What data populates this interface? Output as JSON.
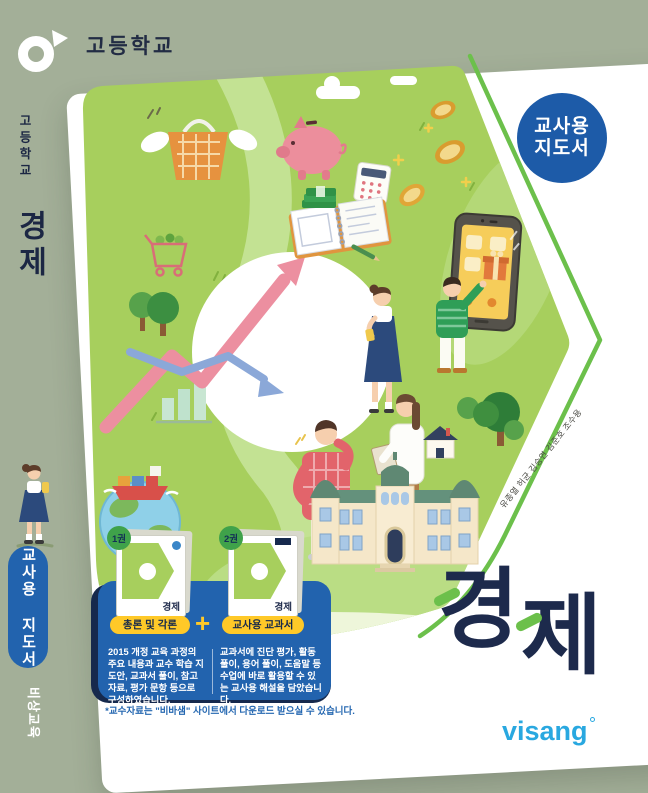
{
  "cover": {
    "school_level": "고등학교",
    "subject": "경제",
    "badge": {
      "line1": "교사용",
      "line2": "지도서"
    },
    "title_char_1": "경",
    "title_char_2": "제",
    "authors": "유종열 허균 김승연 김준호 조수용",
    "footnote": "*교수자료는 \"비바샘\" 사이트에서 다운로드 받으실 수 있습니다.",
    "publisher_logo": "visang"
  },
  "spine": {
    "school_level": "고등학교",
    "subject": "경제",
    "teacher_guide_label": "교사용 지도서",
    "publisher": "비상교육"
  },
  "panel": {
    "plus": "+",
    "books": [
      {
        "volume": "1권",
        "label": "총론 및 각론",
        "cover_title": "경제",
        "description": "2015 개정 교육 과정의 주요 내용과 교수 학습 지도안, 교과서 풀이, 참고 자료, 평가 문항 등으로 구성하였습니다."
      },
      {
        "volume": "2권",
        "label": "교사용 교과서",
        "cover_title": "경제",
        "description": "교과서에 진단 평가, 활동 풀이, 용어 풀이, 도움말 등 수업에 바로 활용할 수 있는 교사용 해설을 담았습니다."
      }
    ]
  },
  "colors": {
    "background": "#a3af98",
    "card": "#ffffff",
    "illustration_green": "#a7cf5d",
    "badge_blue": "#1d5ba8",
    "panel_blue": "#2263ae",
    "navy": "#1d2a4c",
    "accent_green": "#6cc04b",
    "label_yellow": "#ffc928",
    "visang_blue": "#29a8e0"
  },
  "illustration_icons": [
    "flying-basket-icon",
    "piggy-bank-icon",
    "calculator-icon",
    "money-stack-icon",
    "notebook-icon",
    "coin-icon",
    "shopping-cart-icon",
    "growth-arrow-icon",
    "decline-arrow-icon",
    "bar-chart-icon",
    "smartphone-icon",
    "gift-icon",
    "globe-ship-icon",
    "bank-building-icon",
    "tree-icon",
    "house-icon",
    "cloud-icon",
    "walking-girl-icon"
  ]
}
